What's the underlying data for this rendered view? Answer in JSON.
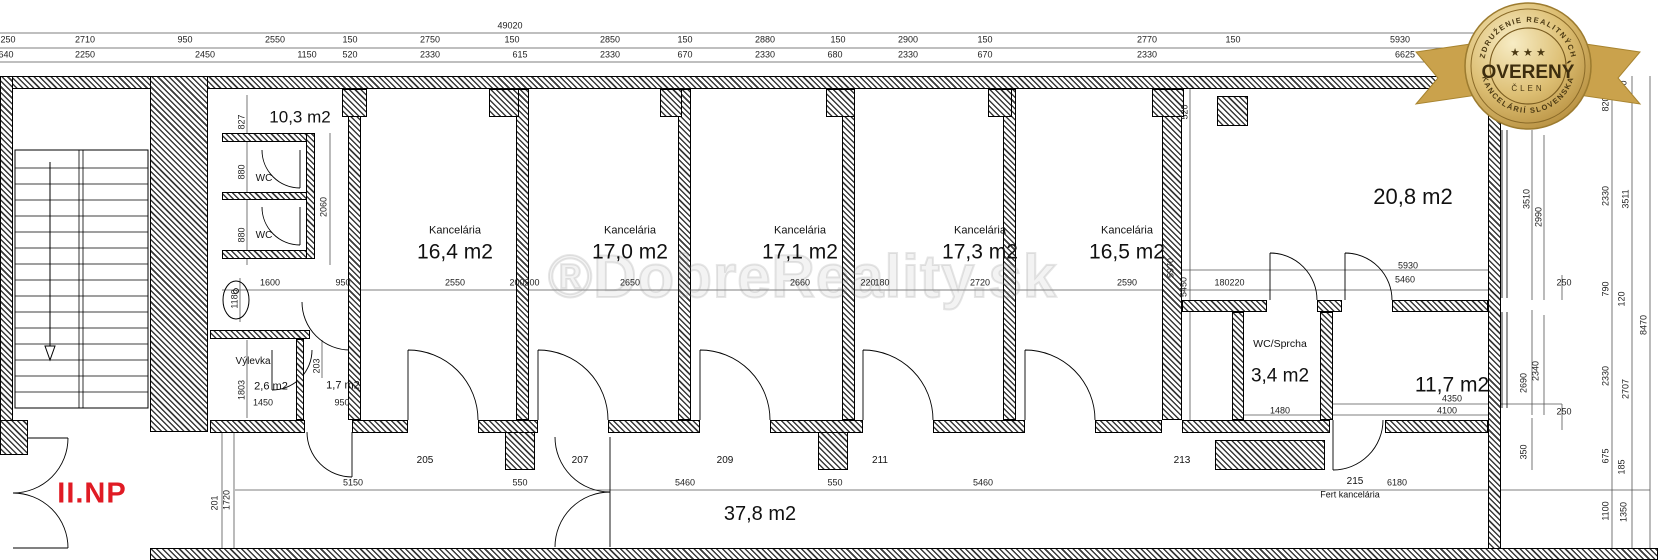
{
  "floor_label": "II.NP",
  "watermark": "®DobreReality.sk",
  "badge": {
    "top_arc": "ZDRUŽENIE REALITNÝCH",
    "stars": "★ ★ ★",
    "title": "OVERENÝ",
    "subtitle": "ČLEN",
    "bottom_arc": "KANCELÁRIÍ SLOVENSKA",
    "colors": {
      "gold_light": "#f3e3b0",
      "gold": "#d9b96a",
      "gold_dark": "#b68e3e",
      "ribbon": "#caa24c",
      "text": "#4a3812"
    }
  },
  "rooms": {
    "hall": {
      "area": "10,3 m2"
    },
    "wc1": {
      "label": "WC"
    },
    "wc2": {
      "label": "WC"
    },
    "vylevka": {
      "label": "Výlevka",
      "area": "2,6 m2"
    },
    "small_room": {
      "area": "1,7 m2"
    },
    "offices": [
      {
        "label": "Kancelária",
        "area": "16,4 m2"
      },
      {
        "label": "Kancelária",
        "area": "17,0 m2"
      },
      {
        "label": "Kancelária",
        "area": "17,1 m2"
      },
      {
        "label": "Kancelária",
        "area": "17,3 m2"
      },
      {
        "label": "Kancelária",
        "area": "16,5 m2"
      }
    ],
    "big_room": {
      "area": "20,8 m2"
    },
    "wc_sprcha": {
      "label": "WC/Sprcha",
      "area": "3,4 m2"
    },
    "room_117": {
      "area": "11,7 m2"
    },
    "corridor": {
      "area": "37,8 m2"
    }
  },
  "room_numbers": [
    "205",
    "207",
    "209",
    "211",
    "213",
    "215"
  ],
  "annotations": {
    "fert": "Fert kancelária"
  },
  "dims": {
    "overall_top": "49020",
    "row1": [
      "250",
      "2710",
      "950",
      "2550",
      "150",
      "2750",
      "150",
      "2850",
      "150",
      "2880",
      "150",
      "2900",
      "150",
      "2770",
      "150",
      "5930"
    ],
    "row2": [
      "640",
      "2250",
      "2450",
      "1150",
      "520",
      "2330",
      "615",
      "2330",
      "670",
      "2330",
      "680",
      "2330",
      "670",
      "2330",
      "6625"
    ],
    "mid": [
      "1600",
      "950",
      "2550",
      "200",
      "200",
      "2650",
      "2660",
      "220",
      "180",
      "2720",
      "2590",
      "180",
      "220"
    ],
    "left_vert": [
      "827",
      "880",
      "880",
      "2060",
      "1180",
      "1803",
      "203"
    ],
    "left_small": [
      "1450",
      "950"
    ],
    "office_vert": [
      "5970",
      "5450",
      "520"
    ],
    "bottom": [
      "5150",
      "550",
      "5460",
      "550",
      "5460",
      "6180"
    ],
    "bottom_vert": [
      "201",
      "1720"
    ],
    "right_room": [
      "5930",
      "5460",
      "4350",
      "4100",
      "1480",
      "3510",
      "2990",
      "2690",
      "2340",
      "250",
      "250",
      "350"
    ],
    "right_edge": [
      "300",
      "820",
      "2330",
      "3511",
      "790",
      "120",
      "8470",
      "2330",
      "2707",
      "675",
      "185",
      "1100",
      "1350"
    ]
  }
}
